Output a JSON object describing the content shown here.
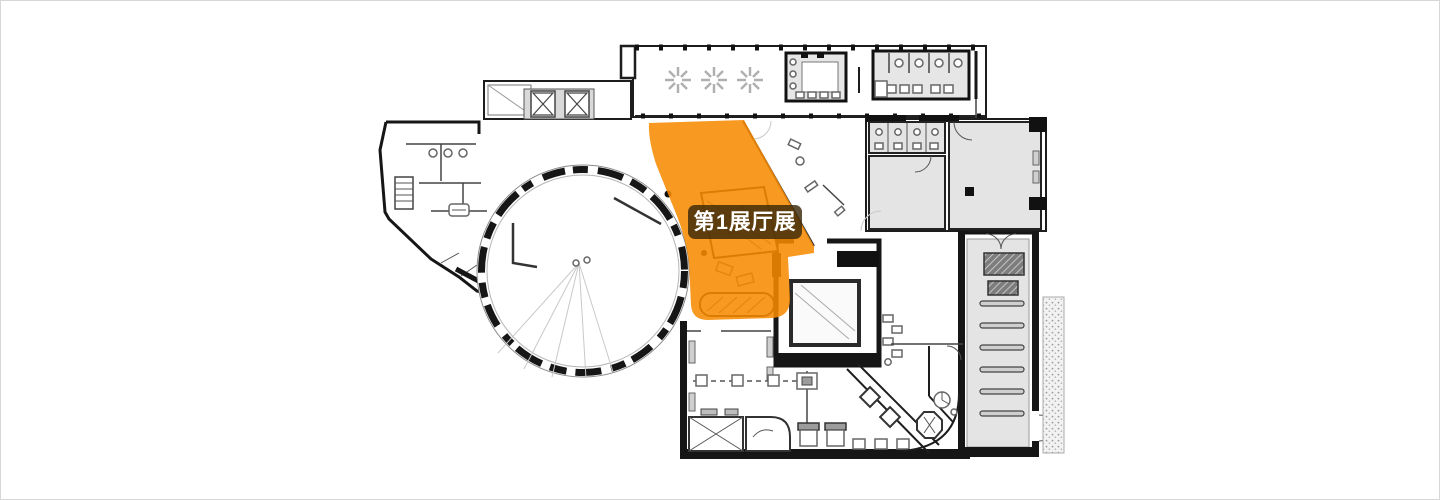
{
  "page": {
    "background_color": "#ffffff",
    "border_color": "#d7d7d7"
  },
  "floorplan": {
    "highlight": {
      "label": "第1展厅展",
      "label_text_color": "#ffffff",
      "label_bg_color": "rgba(58,40,10,0.82)",
      "region_color": "#F78A00",
      "region_opacity": "0.87"
    },
    "palette": {
      "wall_color": "#161616",
      "line_color": "#555555",
      "faint_color": "#c9c9c9",
      "room_fill": "#e4e4e4",
      "elevator_fill": "#d9d9d9",
      "stipple_fill": "#f2f2f2"
    }
  }
}
